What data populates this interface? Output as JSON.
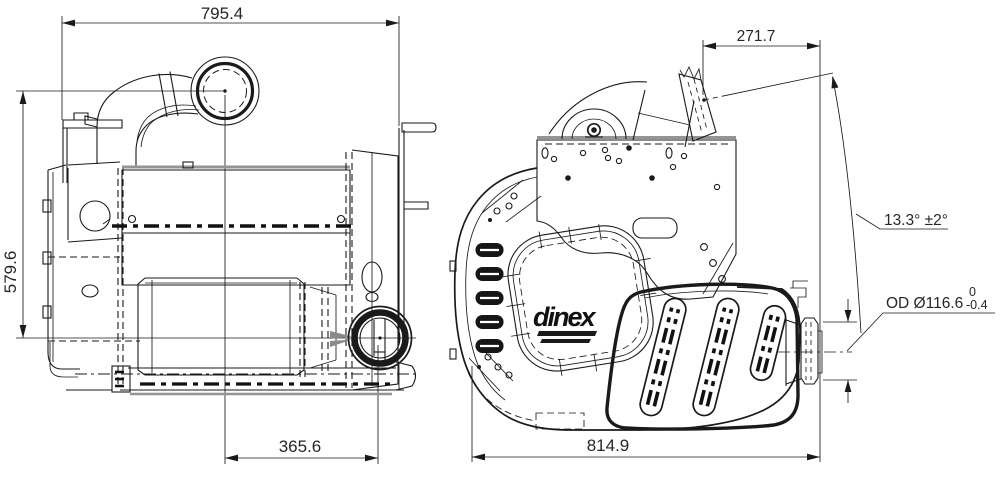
{
  "drawing": {
    "type": "technical-drawing",
    "brand": "dinex",
    "views": {
      "front": "front-view",
      "side": "side-view"
    },
    "dimensions": {
      "front_overall_width": "795.4",
      "front_height": "579.6",
      "front_outlet_offset": "365.6",
      "side_inlet_offset": "271.7",
      "side_inlet_angle": "13.3° ±2°",
      "side_outlet_od": "OD Ø116.6",
      "side_outlet_od_tol_upper": "0",
      "side_outlet_od_tol_lower": "-0.4",
      "side_overall_length": "814.9"
    },
    "colors": {
      "line": "#1a1a1a",
      "accent_gray": "#949494",
      "background": "#ffffff"
    }
  }
}
